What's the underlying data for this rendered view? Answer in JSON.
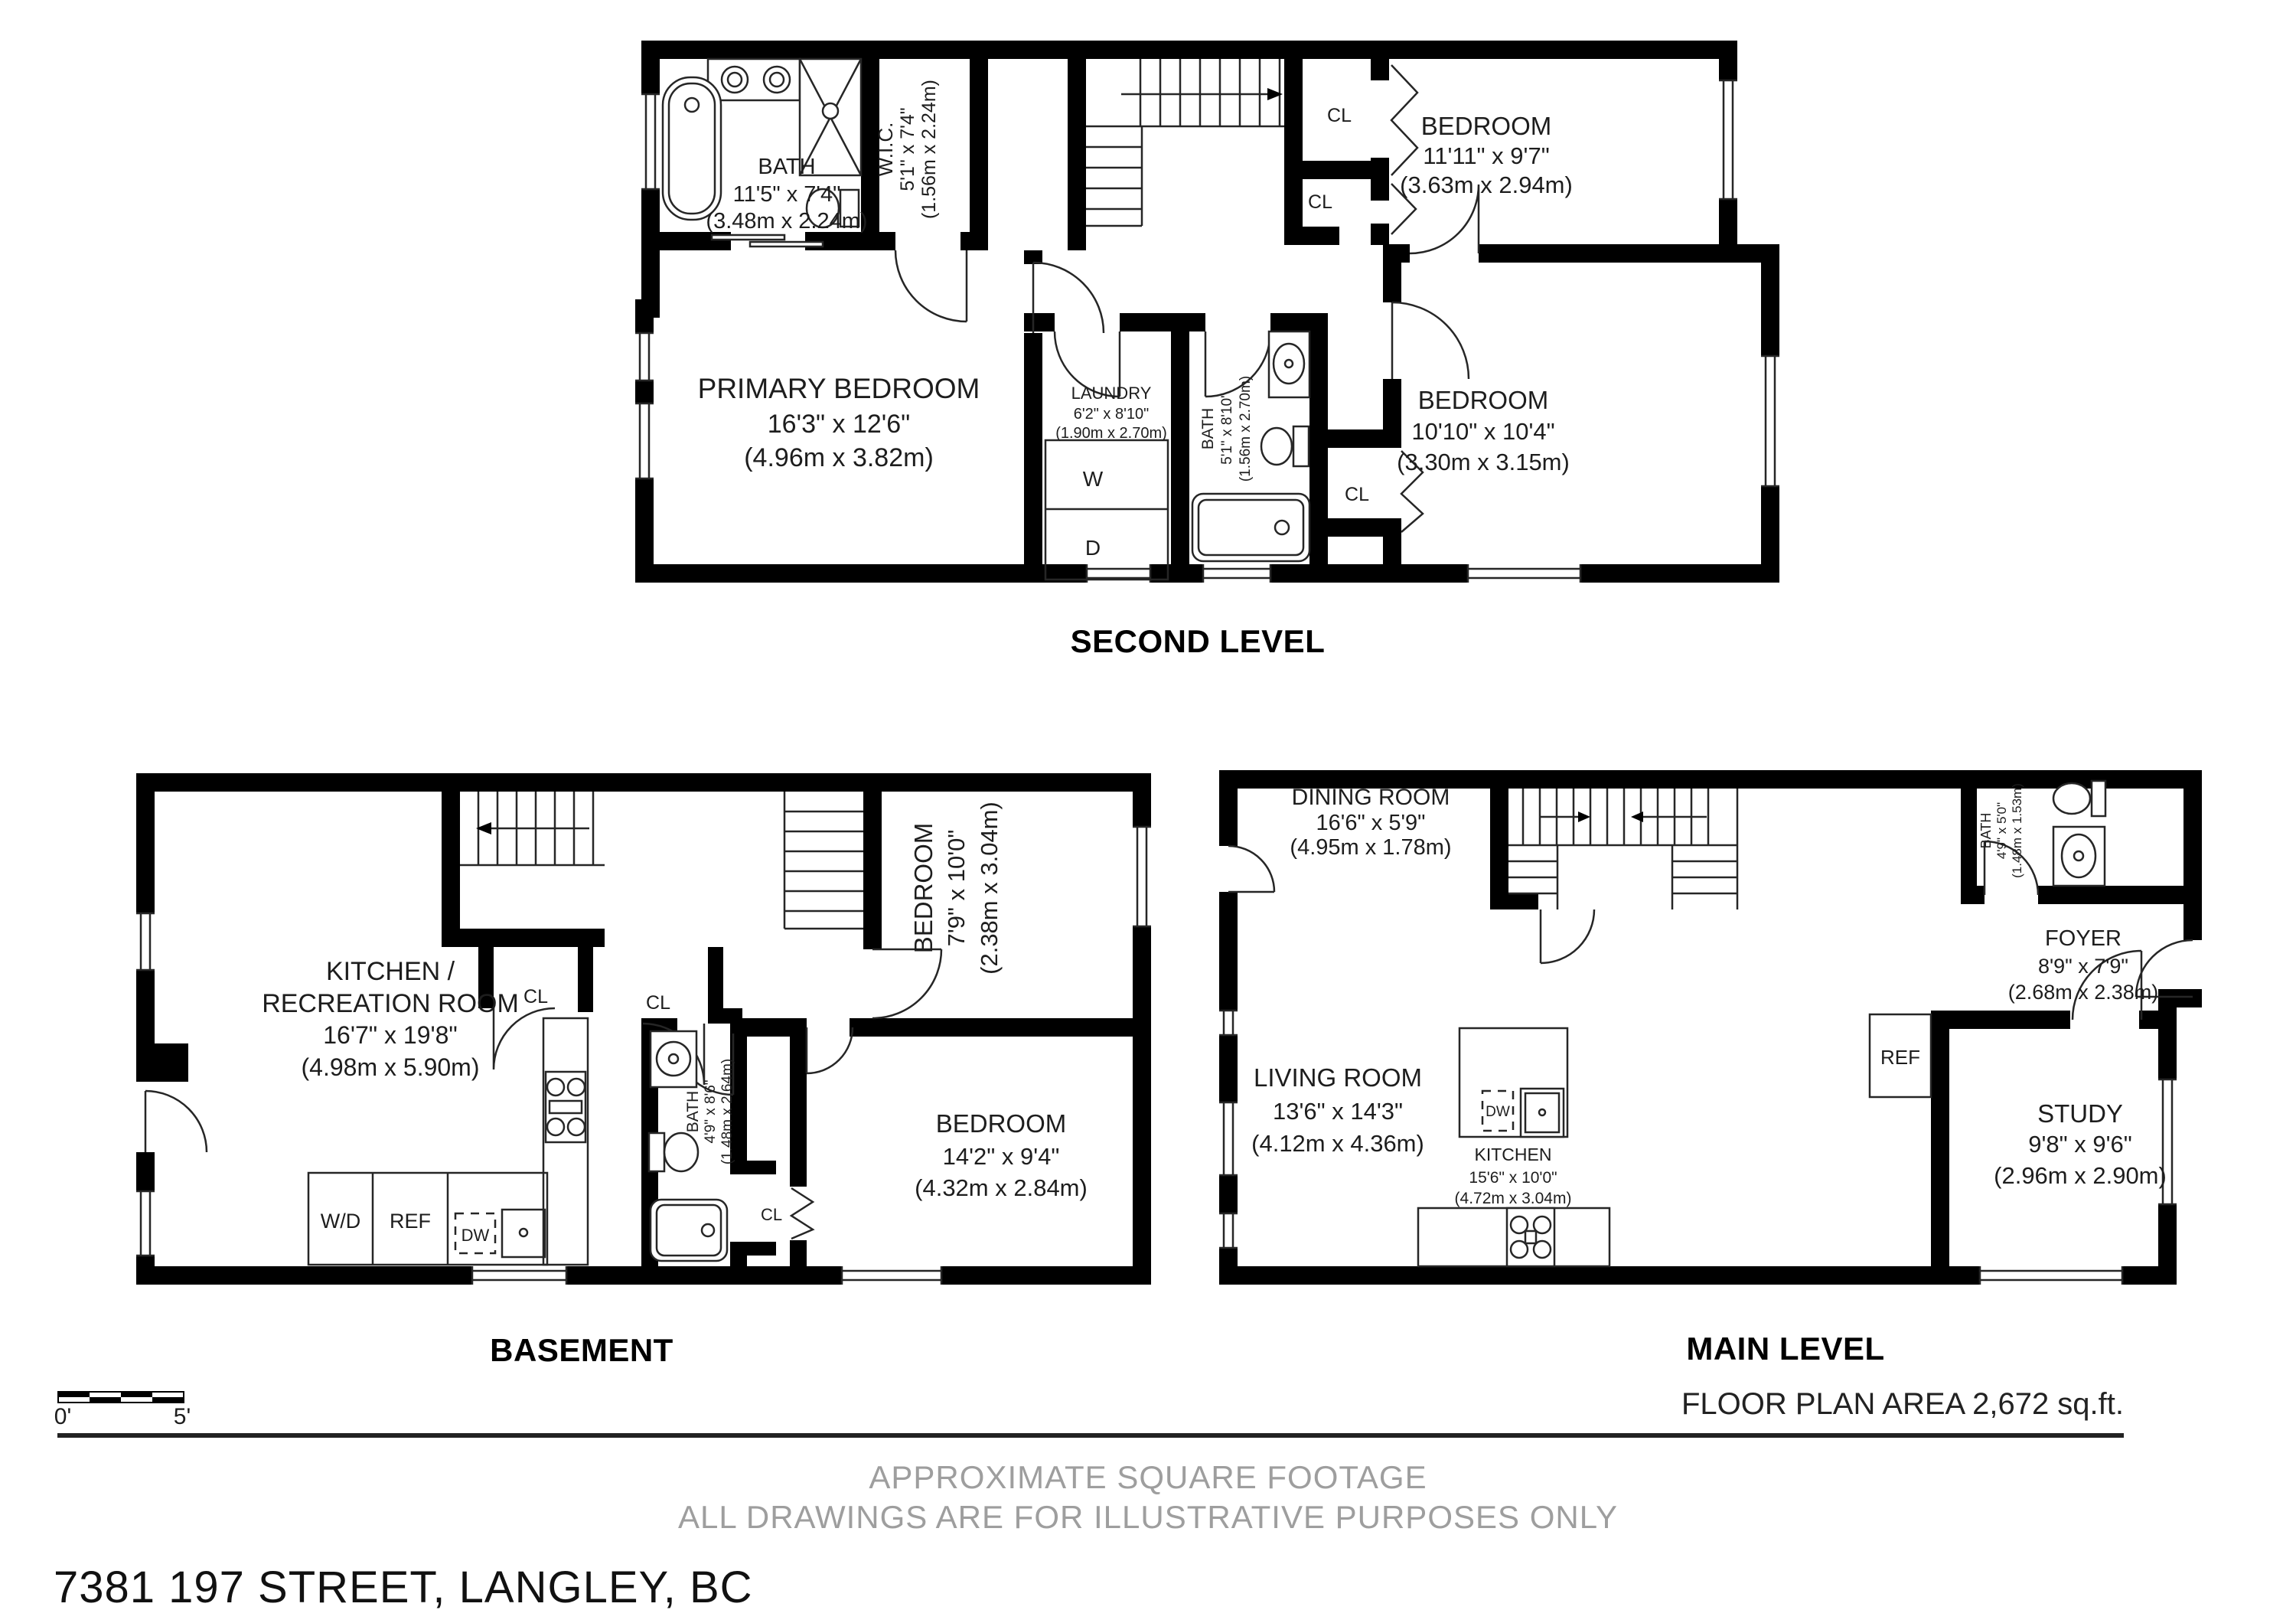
{
  "page": {
    "address": "7381 197 STREET, LANGLEY, BC",
    "floor_area": "FLOOR PLAN AREA 2,672 sq.ft.",
    "disclaimer_line1": "APPROXIMATE SQUARE FOOTAGE",
    "disclaimer_line2": "ALL DRAWINGS ARE FOR ILLUSTRATIVE PURPOSES ONLY",
    "scale": {
      "start": "0'",
      "end": "5'"
    }
  },
  "second": {
    "label": "SECOND LEVEL",
    "bath": {
      "name": "BATH",
      "imperial": "11'5\" x 7'4\"",
      "metric": "(3.48m x 2.24m)"
    },
    "wic": {
      "name": "W.I.C.",
      "imperial": "5'1\" x 7'4\"",
      "metric": "(1.56m x 2.24m)"
    },
    "bedroom_top": {
      "name": "BEDROOM",
      "imperial": "11'11\" x 9'7\"",
      "metric": "(3.63m x 2.94m)"
    },
    "primary": {
      "name": "PRIMARY BEDROOM",
      "imperial": "16'3\" x 12'6\"",
      "metric": "(4.96m x 3.82m)"
    },
    "laundry": {
      "name": "LAUNDRY",
      "imperial": "6'2\" x 8'10\"",
      "metric": "(1.90m x 2.70m)"
    },
    "bath2": {
      "name": "BATH",
      "imperial": "5'1\" x 8'10\"",
      "metric": "(1.56m x 2.70m)"
    },
    "bedroom_bottom": {
      "name": "BEDROOM",
      "imperial": "10'10\" x 10'4\"",
      "metric": "(3.30m x 3.15m)"
    },
    "closet1": "CL",
    "closet2": "CL",
    "closet3": "CL",
    "washer": "W",
    "dryer": "D"
  },
  "basement": {
    "label": "BASEMENT",
    "kitchen_rec": {
      "name1": "KITCHEN /",
      "name2": "RECREATION ROOM",
      "imperial": "16'7\" x 19'8\"",
      "metric": "(4.98m x 5.90m)"
    },
    "bedroom_small": {
      "name": "BEDROOM",
      "imperial": "7'9\" x 10'0\"",
      "metric": "(2.38m x 3.04m)"
    },
    "bedroom_large": {
      "name": "BEDROOM",
      "imperial": "14'2\" x 9'4\"",
      "metric": "(4.32m x 2.84m)"
    },
    "bath": {
      "name": "BATH",
      "imperial": "4'9\" x 8'6\"",
      "metric": "(1.48m x 2.64m)"
    },
    "closet1": "CL",
    "closet2": "CL",
    "closet3": "CL",
    "washer_dryer": "W/D",
    "fridge": "REF",
    "dishwasher": "DW"
  },
  "main": {
    "label": "MAIN LEVEL",
    "dining": {
      "name": "DINING ROOM",
      "imperial": "16'6\" x 5'9\"",
      "metric": "(4.95m x 1.78m)"
    },
    "bath": {
      "name": "BATH",
      "imperial": "4'9\" x 5'0\"",
      "metric": "(1.48m x 1.53m)"
    },
    "foyer": {
      "name": "FOYER",
      "imperial": "8'9\" x 7'9\"",
      "metric": "(2.68m x 2.38m)"
    },
    "living": {
      "name": "LIVING ROOM",
      "imperial": "13'6\" x 14'3\"",
      "metric": "(4.12m x 4.36m)"
    },
    "kitchen": {
      "name": "KITCHEN",
      "imperial": "15'6\" x 10'0\"",
      "metric": "(4.72m x 3.04m)"
    },
    "study": {
      "name": "STUDY",
      "imperial": "9'8\" x 9'6\"",
      "metric": "(2.96m x 2.90m)"
    },
    "fridge": "REF",
    "dishwasher": "DW"
  }
}
